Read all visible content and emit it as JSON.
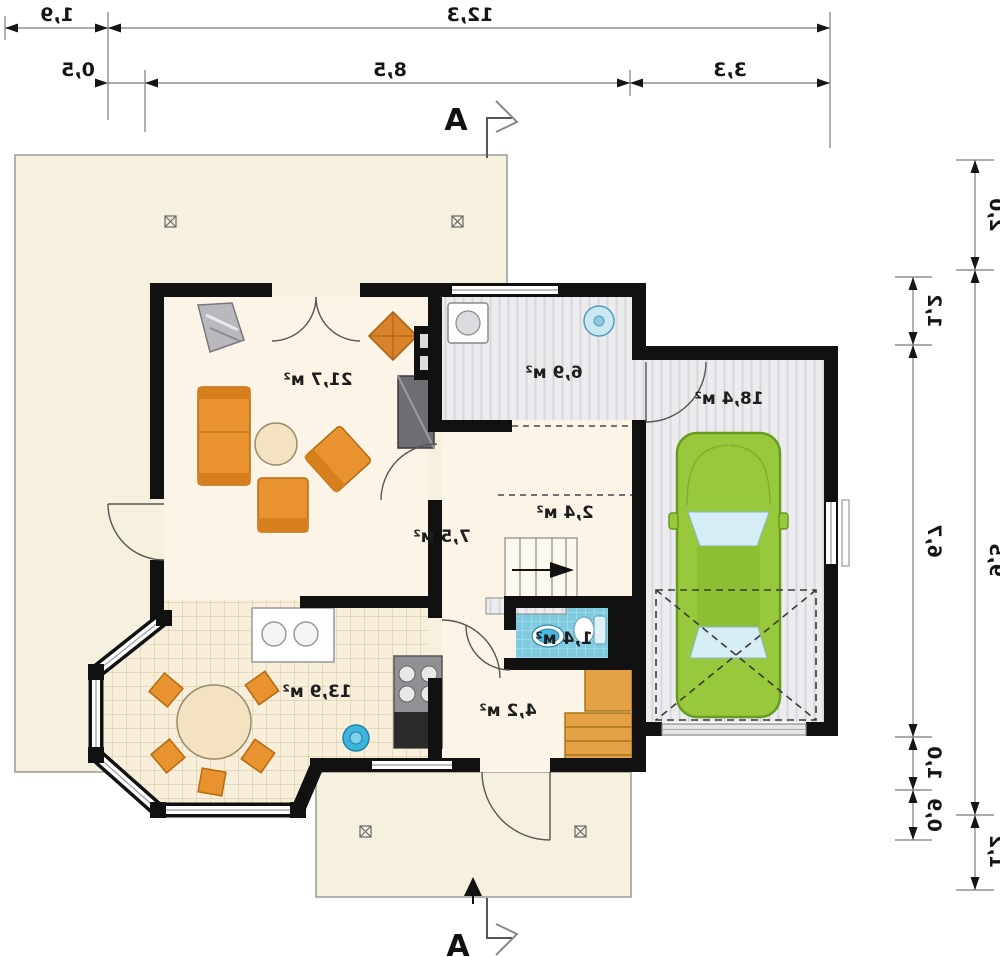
{
  "plan": {
    "mirrored": true,
    "section_marker": {
      "top": "А",
      "bottom": "А"
    },
    "rooms": {
      "living": "21,7 м²",
      "hall": "7,5 м²",
      "wardrobe": "2,4 м²",
      "kitchen": "13,9 м²",
      "utility": "6,9 м²",
      "garage": "18,4 м²",
      "wc": "1,4 м²",
      "storage": "4,2 м²"
    },
    "dims_top": {
      "terrace_width": "1,9",
      "total_width": "12,3",
      "seg_left": "0,5",
      "seg_mid": "8,5",
      "seg_right": "3,3"
    },
    "dims_right": {
      "outer_top": "2,0",
      "outer_mid": "9,5",
      "outer_bottom": "1,2",
      "inner_top": "1,2",
      "inner_mid": "6,7",
      "inner_low": "1,0",
      "inner_bottom": "0,9"
    },
    "colors": {
      "wall": "#111111",
      "terrace": "#f6f0df",
      "floor": "#fcf5e7",
      "tile_floor": "#f8efdb",
      "furniture_orange": "#e8932f",
      "wood": "#e5a145",
      "car_green": "#98c93c",
      "wc_blue": "#7fcbe0",
      "dim_line": "#8f8f8f"
    }
  }
}
